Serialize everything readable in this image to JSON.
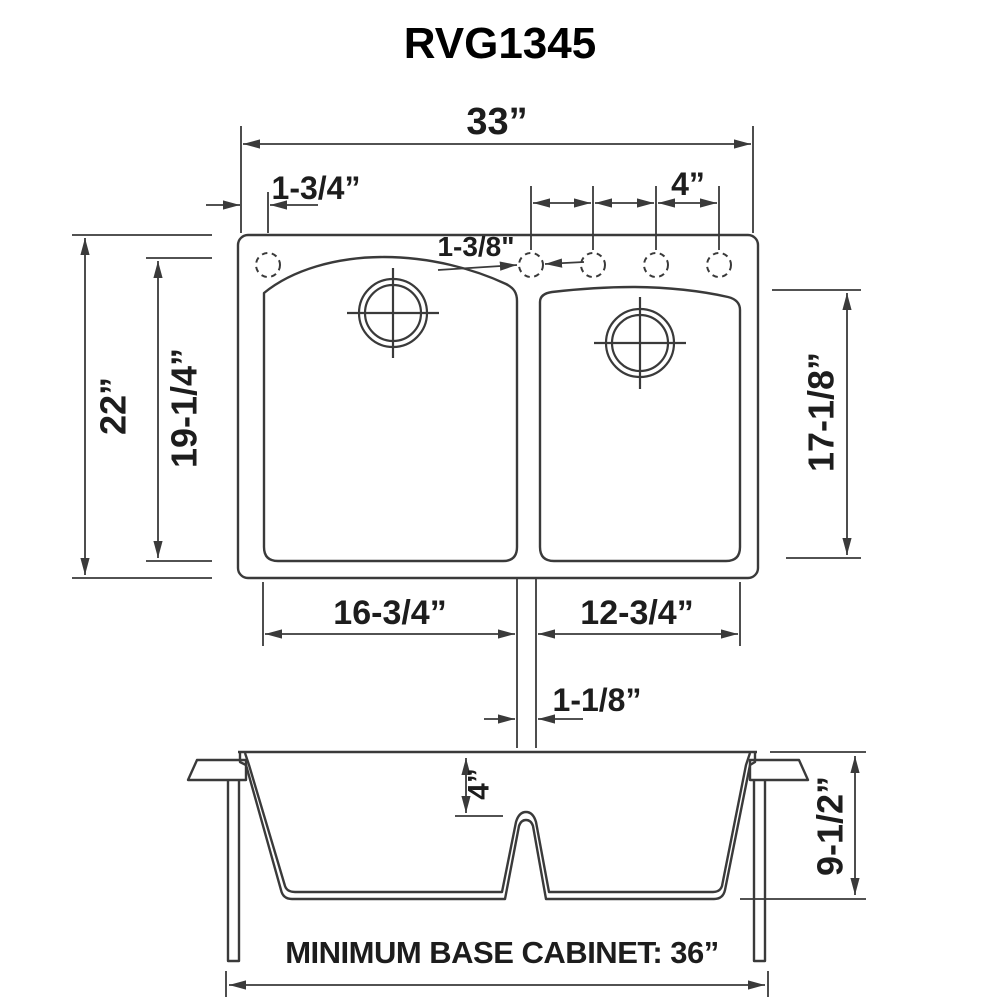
{
  "title": "RVG1345",
  "top_view": {
    "overall_width": "33”",
    "first_hole_offset": "1-3/4”",
    "hole_spacing": "4”",
    "hole_diameter": "1-3/8\"",
    "overall_depth": "22”",
    "large_bowl_length": "19-1/4”",
    "small_bowl_length": "17-1/8”",
    "large_bowl_width": "16-3/4”",
    "small_bowl_width": "12-3/4”",
    "divider_width": "1-1/8”"
  },
  "front_view": {
    "divider_drop": "4”",
    "bowl_depth": "9-1/2”",
    "base_cabinet_note": "MINIMUM BASE CABINET: 36”"
  },
  "colors": {
    "line": "#3a3a3a",
    "text": "#1d1d1d",
    "background": "#ffffff"
  }
}
